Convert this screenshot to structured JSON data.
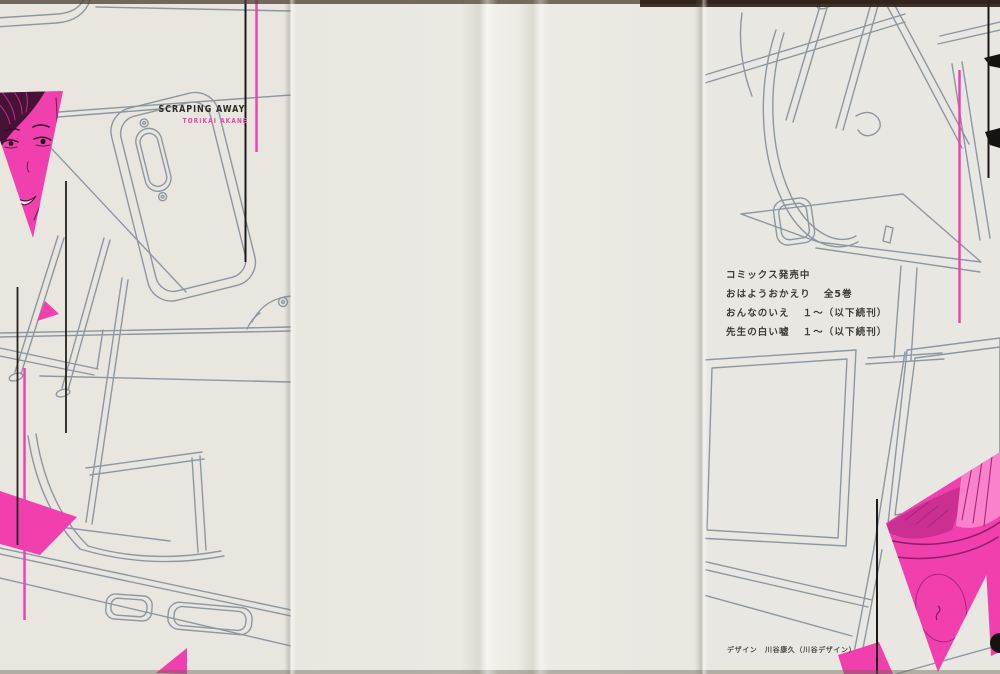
{
  "flap": {
    "title_en": "SCRAPING AWAY.",
    "author_en": "TORIKAI AKANE"
  },
  "back_panel": {
    "ads_heading": "コミックス発売中",
    "ads": [
      {
        "title": "おはようおかえり",
        "volumes": "全5巻"
      },
      {
        "title": "おんなのいえ",
        "volumes": "１～（以下続刊）"
      },
      {
        "title": "先生の白い嘘",
        "volumes": "１～（以下続刊）"
      }
    ],
    "design_credit": "デザイン　川谷康久（川谷デザイン）"
  },
  "colors": {
    "accent_pink": "#f13fae",
    "line_art": "#8d97a2",
    "ink": "#2d2a27",
    "paper": "#e9e7e0"
  }
}
